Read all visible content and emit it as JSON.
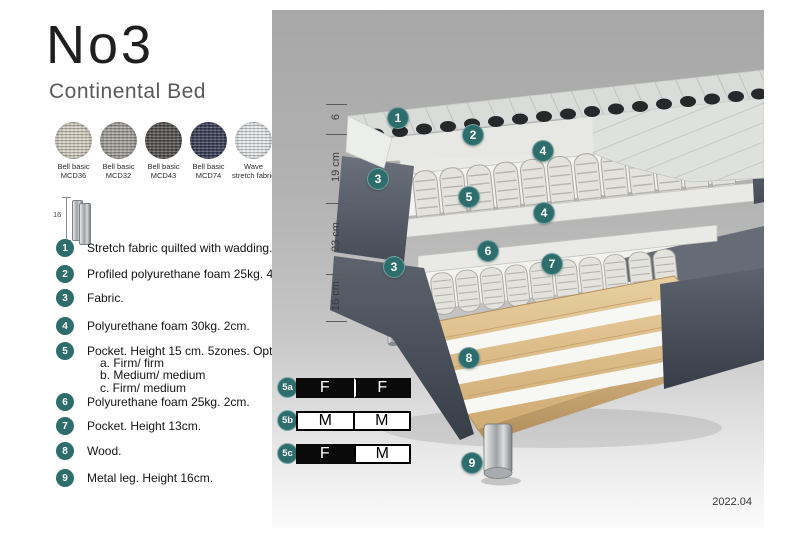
{
  "header": {
    "title": "No3",
    "subtitle": "Continental Bed"
  },
  "swatches": [
    {
      "name": "Bell basic",
      "code": "MCD36",
      "color": "#d6d0c2"
    },
    {
      "name": "Bell basic",
      "code": "MCD32",
      "color": "#a5a29b"
    },
    {
      "name": "Bell basic",
      "code": "MCD43",
      "color": "#555350"
    },
    {
      "name": "Bell basic",
      "code": "MCD74",
      "color": "#3c4058"
    },
    {
      "name": "Wave",
      "code": "stretch fabric",
      "color": "#e8eaec"
    }
  ],
  "leg_icon": {
    "height_label": "16"
  },
  "legend": {
    "items": [
      {
        "num": "1",
        "text": "Stretch fabric quilted with wadding."
      },
      {
        "num": "2",
        "text": "Profiled polyurethane foam 25kg. 4cm."
      },
      {
        "num": "3",
        "text": "Fabric."
      },
      {
        "num": "4",
        "text": "Polyurethane foam 30kg. 2cm."
      },
      {
        "num": "5",
        "text": "Pocket. Height 15 cm. 5zones. Option:",
        "options": [
          "a. Firm/ firm",
          "b. Medium/ medium",
          "c. Firm/ medium"
        ]
      },
      {
        "num": "6",
        "text": "Polyurethane foam 25kg. 2cm."
      },
      {
        "num": "7",
        "text": "Pocket. Height 13cm."
      },
      {
        "num": "8",
        "text": "Wood."
      },
      {
        "num": "9",
        "text": "Metal leg. Height 16cm."
      }
    ]
  },
  "diagram": {
    "dimensions": [
      {
        "label": "6"
      },
      {
        "label": "19 cm"
      },
      {
        "label": "23 cm"
      },
      {
        "label": "16 cm"
      }
    ],
    "badges": [
      {
        "num": "1"
      },
      {
        "num": "2"
      },
      {
        "num": "4"
      },
      {
        "num": "3"
      },
      {
        "num": "5"
      },
      {
        "num": "4"
      },
      {
        "num": "6"
      },
      {
        "num": "7"
      },
      {
        "num": "3"
      },
      {
        "num": "8"
      },
      {
        "num": "9"
      }
    ],
    "version": "2022.04"
  },
  "firmness": {
    "rows": [
      {
        "label": "5a",
        "cells": [
          {
            "text": "F",
            "variant": "dark"
          },
          {
            "text": "F",
            "variant": "dark"
          }
        ]
      },
      {
        "label": "5b",
        "cells": [
          {
            "text": "M",
            "variant": "light"
          },
          {
            "text": "M",
            "variant": "light"
          }
        ]
      },
      {
        "label": "5c",
        "cells": [
          {
            "text": "F",
            "variant": "dark"
          },
          {
            "text": "M",
            "variant": "light"
          }
        ]
      }
    ]
  },
  "colors": {
    "badge_teal": "#2d6e6d",
    "fabric_dark": "#565c66",
    "wood": "#ddbf8e",
    "metal": "#b9bcbf"
  }
}
